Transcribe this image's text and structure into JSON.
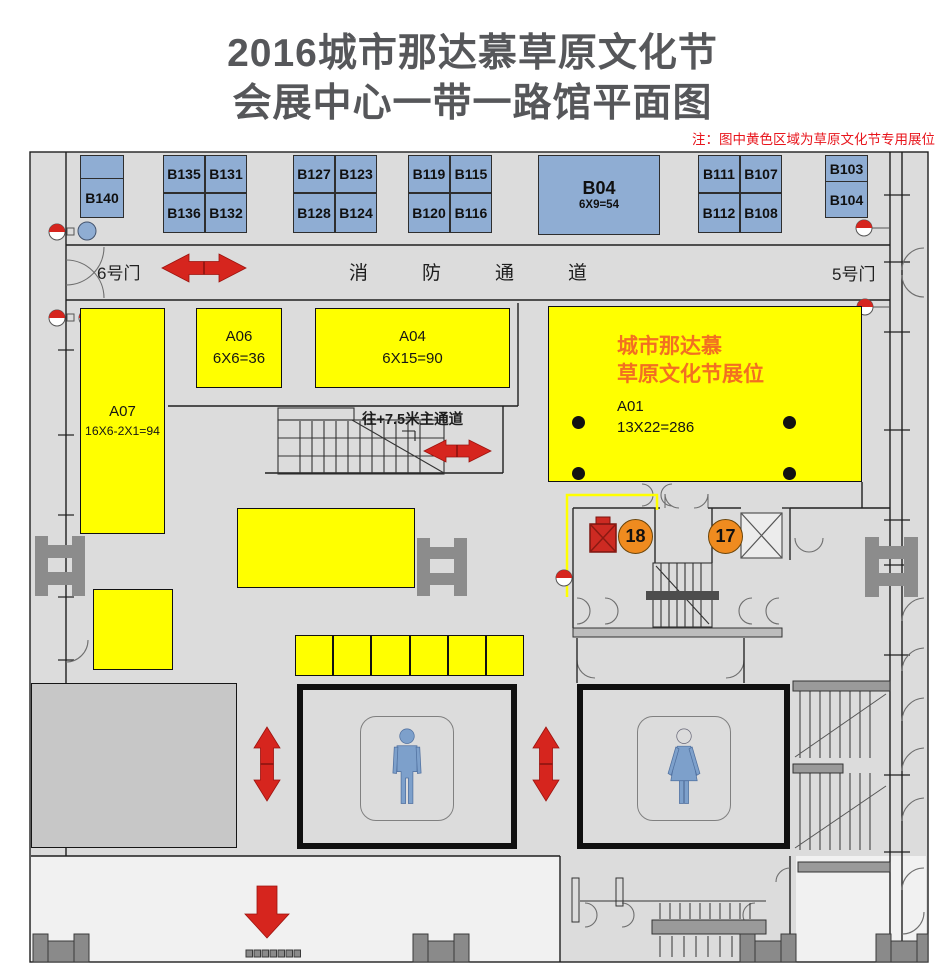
{
  "title": {
    "line1": "2016城市那达慕草原文化节",
    "line2": "会展中心一带一路馆平面图",
    "note": "注：图中黄色区域为草原文化节专用展位"
  },
  "gates": {
    "gate6": "6号门",
    "gate5": "5号门"
  },
  "corridors": {
    "fire_lane": "消防通道",
    "main_aisle": "往+7.5米主通道"
  },
  "blue_booths": {
    "b140": "B140",
    "b135": "B135",
    "b131": "B131",
    "b136": "B136",
    "b132": "B132",
    "b127": "B127",
    "b123": "B123",
    "b128": "B128",
    "b124": "B124",
    "b119": "B119",
    "b115": "B115",
    "b120": "B120",
    "b116": "B116",
    "b04": {
      "id": "B04",
      "size": "6X9=54"
    },
    "b111": "B111",
    "b107": "B107",
    "b112": "B112",
    "b108": "B108",
    "b103": "B103",
    "b104": "B104"
  },
  "yellow_booths": {
    "a07": {
      "id": "A07",
      "size": "16X6-2X1=94"
    },
    "a06": {
      "id": "A06",
      "size": "6X6=36"
    },
    "a04": {
      "id": "A04",
      "size": "6X15=90"
    },
    "a01": {
      "id": "A01",
      "size": "13X22=286",
      "festival_line1": "城市那达慕",
      "festival_line2": "草原文化节展位"
    }
  },
  "markers": {
    "circle_18": "18",
    "circle_17": "17"
  },
  "colors": {
    "booth_blue": "#8fadd3",
    "booth_yellow": "#ffff00",
    "arrow_red": "#d6251e",
    "marker_orange": "#ef8b1f",
    "festival_text": "#f26f21",
    "note_red": "#e8151c",
    "title_gray": "#56575a",
    "hall_gray": "#dcdcdc"
  }
}
